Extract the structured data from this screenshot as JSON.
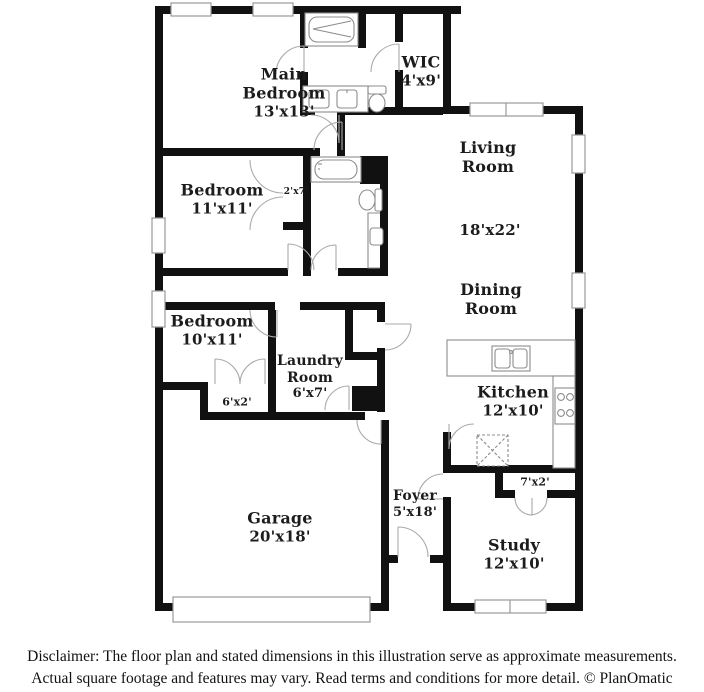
{
  "rooms": [
    {
      "id": "main-bedroom",
      "name": "Main Bedroom",
      "dims": "13'x13'"
    },
    {
      "id": "wic",
      "name": "WIC",
      "dims": "4'x9'"
    },
    {
      "id": "bedroom-11",
      "name": "Bedroom",
      "dims": "11'x11'"
    },
    {
      "id": "living-room",
      "name": "Living Room",
      "dims": "18'x22'"
    },
    {
      "id": "dining-room",
      "name": "Dining Room",
      "dims": ""
    },
    {
      "id": "bedroom-10",
      "name": "Bedroom",
      "dims": "10'x11'"
    },
    {
      "id": "laundry-room",
      "name": "Laundry Room",
      "dims": "6'x7'"
    },
    {
      "id": "kitchen",
      "name": "Kitchen",
      "dims": "12'x10'"
    },
    {
      "id": "garage",
      "name": "Garage",
      "dims": "20'x18'"
    },
    {
      "id": "foyer",
      "name": "Foyer",
      "dims": "5'x18'"
    },
    {
      "id": "study",
      "name": "Study",
      "dims": "12'x10'"
    }
  ],
  "closets": [
    {
      "label": "2'x7'"
    },
    {
      "label": "6'x2'"
    },
    {
      "label": "7'x2'"
    }
  ],
  "footer": {
    "line1": "Disclaimer: The floor plan and stated dimensions in this illustration serve as approximate measurements.",
    "line2": "Actual square footage and features may vary. Read terms and conditions for more detail. © PlanOmatic"
  },
  "colors": {
    "wall": "#111111",
    "window_stroke": "#999999",
    "door_stroke": "#aaaaaa",
    "fixture_stroke": "#8c8c8c",
    "text": "#1c1c1c"
  }
}
